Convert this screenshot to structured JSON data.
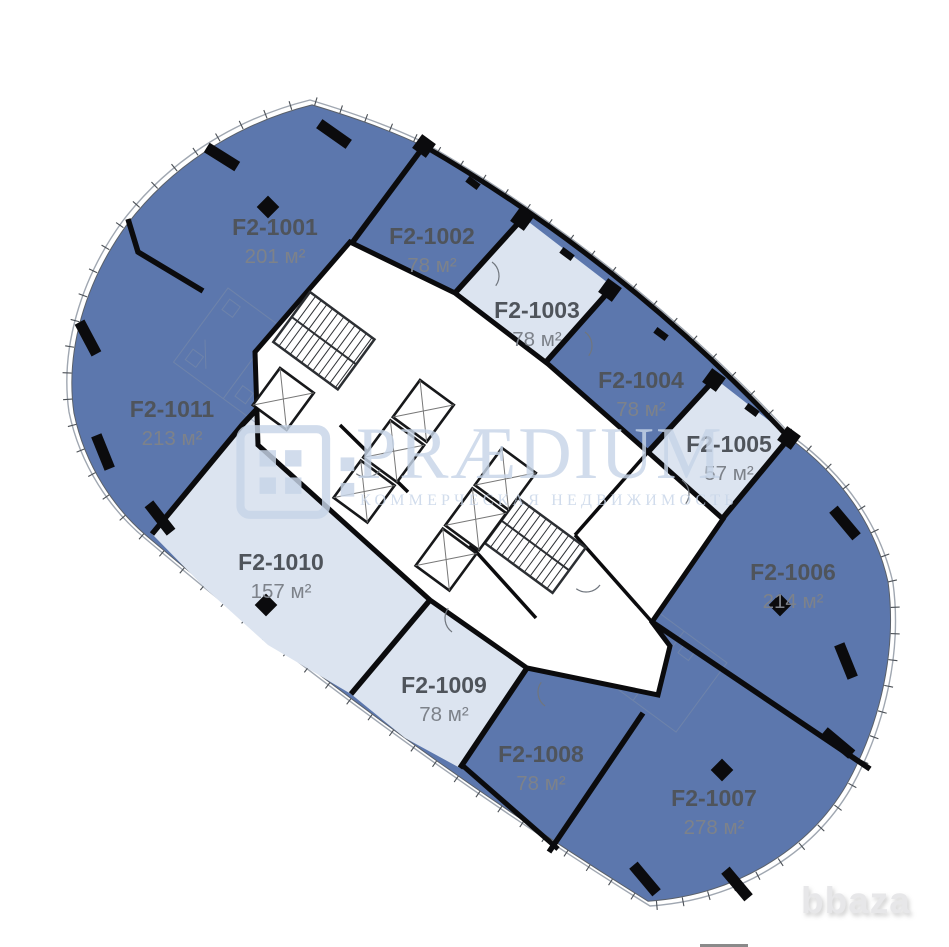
{
  "watermark": {
    "brand": "PRÆDIUM",
    "subtitle": "КОММЕРЧЕСКАЯ НЕДВИЖИМОСТЬ"
  },
  "footer_watermark": {
    "label": "bbaza"
  },
  "palette": {
    "unit_blue": "#5c77ad",
    "unit_light": "#dce4f0",
    "wall": "#0b0b0d",
    "facade_line": "#a0a7b1",
    "inner_line": "#5a6069",
    "tick": "#4a4f55",
    "label": "#4f545b",
    "area_label": "#7d828a",
    "sketch": "#7e8ea8",
    "door_arc": "#70767e",
    "watermark_blue": "#c7d5e8",
    "bbaza_gray": "#e7e7e9"
  },
  "floor_plan": {
    "units": [
      {
        "id": "F2-1001",
        "area": "201 м²",
        "fill": "blue",
        "label_pos": [
          275,
          235
        ]
      },
      {
        "id": "F2-1002",
        "area": "78 м²",
        "fill": "blue",
        "label_pos": [
          432,
          244
        ]
      },
      {
        "id": "F2-1003",
        "area": "78 м²",
        "fill": "light",
        "label_pos": [
          537,
          318
        ],
        "polygon": [
          [
            521,
            216
          ],
          [
            612,
            286
          ],
          [
            546,
            362
          ],
          [
            455,
            292
          ]
        ]
      },
      {
        "id": "F2-1004",
        "area": "78 м²",
        "fill": "blue",
        "label_pos": [
          641,
          388
        ]
      },
      {
        "id": "F2-1005",
        "area": "57 м²",
        "fill": "light",
        "label_pos": [
          729,
          452
        ],
        "polygon": [
          [
            713,
            377
          ],
          [
            790,
            437
          ],
          [
            722,
            519
          ],
          [
            648,
            452
          ]
        ]
      },
      {
        "id": "F2-1006",
        "area": "214 м²",
        "fill": "blue",
        "label_pos": [
          793,
          580
        ]
      },
      {
        "id": "F2-1007",
        "area": "278 м²",
        "fill": "blue",
        "label_pos": [
          714,
          806
        ]
      },
      {
        "id": "F2-1008",
        "area": "78 м²",
        "fill": "blue",
        "label_pos": [
          541,
          762
        ]
      },
      {
        "id": "F2-1009",
        "area": "78 м²",
        "fill": "light",
        "label_pos": [
          444,
          693
        ],
        "polygon": [
          [
            351,
            694
          ],
          [
            430,
            600
          ],
          [
            527,
            668
          ],
          [
            460,
            768
          ],
          [
            405,
            738
          ]
        ]
      },
      {
        "id": "F2-1010",
        "area": "157 м²",
        "fill": "light",
        "label_pos": [
          281,
          570
        ],
        "polygon": [
          [
            152,
            534
          ],
          [
            243,
            424
          ],
          [
            258,
            408
          ],
          [
            258,
            445
          ],
          [
            430,
            600
          ],
          [
            351,
            694
          ],
          [
            268,
            645
          ],
          [
            205,
            588
          ]
        ]
      },
      {
        "id": "F2-1011",
        "area": "213 м²",
        "fill": "blue",
        "label_pos": [
          172,
          417
        ]
      }
    ],
    "geometry": {
      "angle": 36.3,
      "outline": "M310,100 C350,112 390,126 423,142 Q630,261 793,437 C845,475 880,525 893,583 C902,650 886,725 851,788 C812,855 737,900 650,906 Q385,741 147,540 C110,510 80,465 69,412 C60,350 80,280 122,222 C165,165 230,120 310,100 Z",
      "inner_transform": "translate(5.8,6.1) scale(0.988)",
      "core_polygon": [
        [
          350,
          242
        ],
        [
          455,
          293
        ],
        [
          548,
          364
        ],
        [
          648,
          452
        ],
        [
          723,
          519
        ],
        [
          652,
          622
        ],
        [
          670,
          646
        ],
        [
          658,
          695
        ],
        [
          527,
          668
        ],
        [
          430,
          600
        ],
        [
          258,
          445
        ],
        [
          255,
          352
        ]
      ],
      "facade_walls": [
        "M424,146 Q628,264 789,438",
        "M462,765 L558,849"
      ],
      "partitions": [
        [
          [
            424,
            146
          ],
          [
            352,
            243
          ]
        ],
        [
          [
            522,
            219
          ],
          [
            455,
            293
          ]
        ],
        [
          [
            610,
            290
          ],
          [
            546,
            362
          ]
        ],
        [
          [
            714,
            380
          ],
          [
            648,
            452
          ]
        ],
        [
          [
            789,
            438
          ],
          [
            722,
            519
          ]
        ],
        [
          [
            652,
            622
          ],
          [
            870,
            769
          ]
        ],
        [
          [
            643,
            713
          ],
          [
            549,
            852
          ]
        ],
        [
          [
            527,
            668
          ],
          [
            460,
            768
          ]
        ],
        [
          [
            430,
            600
          ],
          [
            351,
            694
          ]
        ],
        [
          [
            152,
            534
          ],
          [
            243,
            424
          ],
          [
            258,
            408
          ]
        ],
        [
          [
            128,
            219
          ],
          [
            138,
            252
          ],
          [
            203,
            291
          ]
        ]
      ],
      "core_walls": [
        [
          [
            648,
            452
          ],
          [
            575,
            535
          ]
        ],
        [
          [
            575,
            535
          ],
          [
            652,
            622
          ]
        ],
        [
          [
            470,
            545
          ],
          [
            536,
            618
          ]
        ],
        [
          [
            340,
            425
          ],
          [
            408,
            492
          ]
        ]
      ],
      "stairs": [
        [
          310,
          292,
          80,
          62
        ],
        [
          518,
          498,
          84,
          56
        ]
      ],
      "elevators": [
        [
          280,
          368,
          1
        ],
        [
          420,
          380,
          3
        ],
        [
          502,
          448,
          3
        ]
      ],
      "columns_bars": [
        [
          222,
          157,
          32
        ],
        [
          334,
          134,
          35
        ],
        [
          88,
          338,
          62
        ],
        [
          103,
          452,
          68
        ],
        [
          160,
          518,
          52
        ],
        [
          846,
          661,
          68
        ],
        [
          845,
          523,
          50
        ],
        [
          838,
          743,
          40
        ],
        [
          645,
          879,
          50
        ],
        [
          737,
          884,
          50
        ]
      ],
      "columns_diamonds": [
        [
          268,
          207
        ],
        [
          266,
          605
        ],
        [
          780,
          605
        ],
        [
          722,
          770
        ]
      ],
      "facade_squares": [
        [
          424,
          146
        ],
        [
          522,
          219
        ],
        [
          610,
          290
        ],
        [
          714,
          380
        ],
        [
          789,
          438
        ]
      ],
      "facade_stubs": [
        [
          473,
          183
        ],
        [
          567,
          254
        ],
        [
          661,
          334
        ],
        [
          752,
          410
        ]
      ],
      "door_arcs": [
        [
          492,
          262,
          36
        ],
        [
          585,
          332,
          36
        ],
        [
          682,
          480,
          36
        ],
        [
          452,
          632,
          216
        ],
        [
          545,
          706,
          216
        ],
        [
          600,
          585,
          126
        ],
        [
          380,
          470,
          126
        ]
      ],
      "sketch_blocks": [
        [
          228,
          288,
          185,
          92
        ],
        [
          598,
          568,
          160,
          86
        ]
      ]
    }
  }
}
